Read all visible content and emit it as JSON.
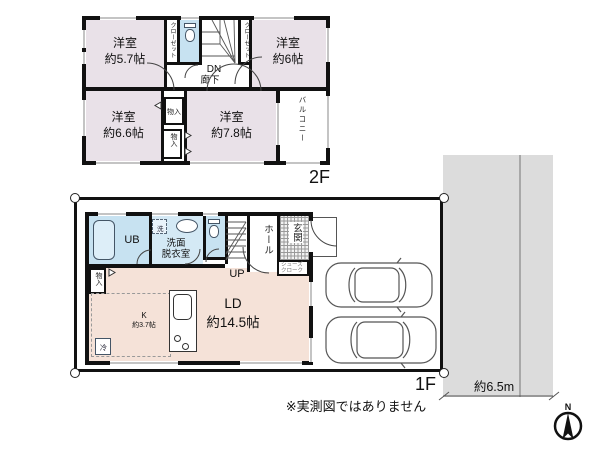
{
  "colors": {
    "room": "#e9e1e8",
    "living": "#f5e2d8",
    "wet": "#c7e2f1",
    "road": "#dcdcdc",
    "wall": "#111111"
  },
  "floor2": {
    "floor_label": "2F",
    "room57": {
      "name": "洋室",
      "size": "約5.7帖"
    },
    "room6": {
      "name": "洋室",
      "size": "約6帖"
    },
    "room66": {
      "name": "洋室",
      "size": "約6.6帖"
    },
    "room78": {
      "name": "洋室",
      "size": "約7.8帖"
    },
    "closet_left": "クローゼット",
    "closet_right": "クローゼット",
    "stairs_down": "DN",
    "hallway": "廊下",
    "storage_upper": "物入",
    "storage_lower": "物入",
    "balcony": "バルコニー"
  },
  "floor1": {
    "floor_label": "1F",
    "unit_bath": "UB",
    "washer": "洗",
    "washroom_line1": "洗面",
    "washroom_line2": "脱衣室",
    "hall": "ホール",
    "entrance": "玄関",
    "shoe_closet_line1": "シューズ",
    "shoe_closet_line2": "クローク",
    "stairs_up": "UP",
    "storage": "物入",
    "kitchen_name": "K",
    "kitchen_size": "約3.7帖",
    "fridge": "冷",
    "living_name": "LD",
    "living_size": "約14.5帖"
  },
  "site": {
    "road_width": "約6.5m",
    "disclaimer": "※実測図ではありません",
    "compass_north": "N"
  }
}
